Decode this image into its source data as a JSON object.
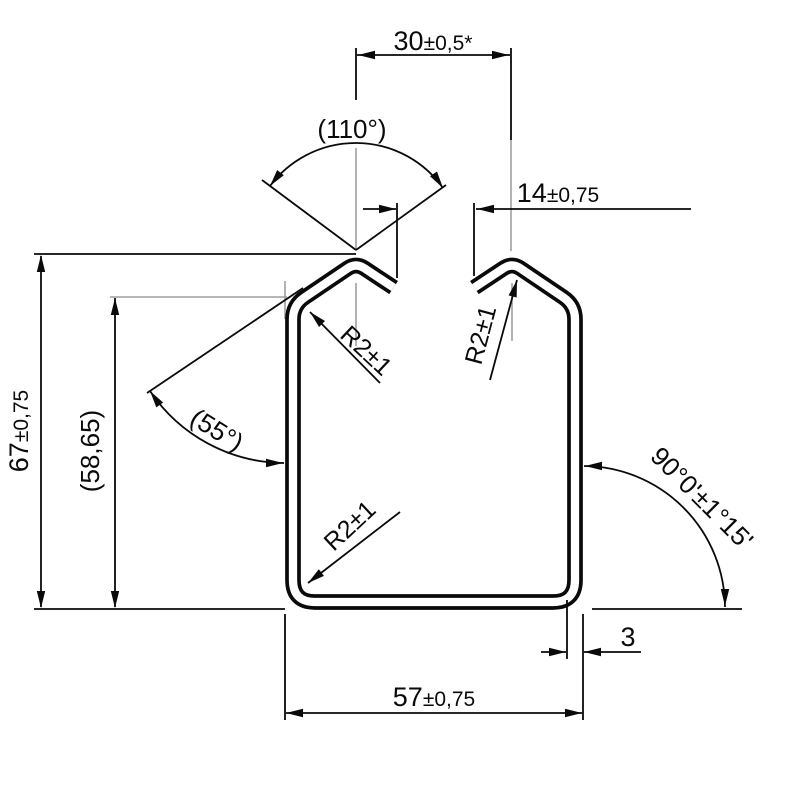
{
  "drawing": {
    "colors": {
      "line": "#0a0a0a",
      "construction": "#9e9e9e",
      "background": "#ffffff"
    },
    "dims": {
      "slot_width": {
        "value": "30",
        "tol": "±0,5*"
      },
      "slot_angle": {
        "label": "(110°)"
      },
      "lip_gap": {
        "value": "14",
        "tol": "±0,75"
      },
      "overall_height": {
        "value": "67",
        "tol": "±0,75"
      },
      "side_height": {
        "label": "(58,65)"
      },
      "chamfer_angle": {
        "label": "(55°)"
      },
      "corner_angle": {
        "label": "90°0'±1°15'"
      },
      "wall_thickness": {
        "label": "3"
      },
      "overall_width": {
        "value": "57",
        "tol": "±0,75"
      },
      "radius_lip_left": {
        "label": "R2±1"
      },
      "radius_lip_right": {
        "label": "R2±1"
      },
      "radius_bottom_left": {
        "label": "R2±1"
      }
    }
  }
}
